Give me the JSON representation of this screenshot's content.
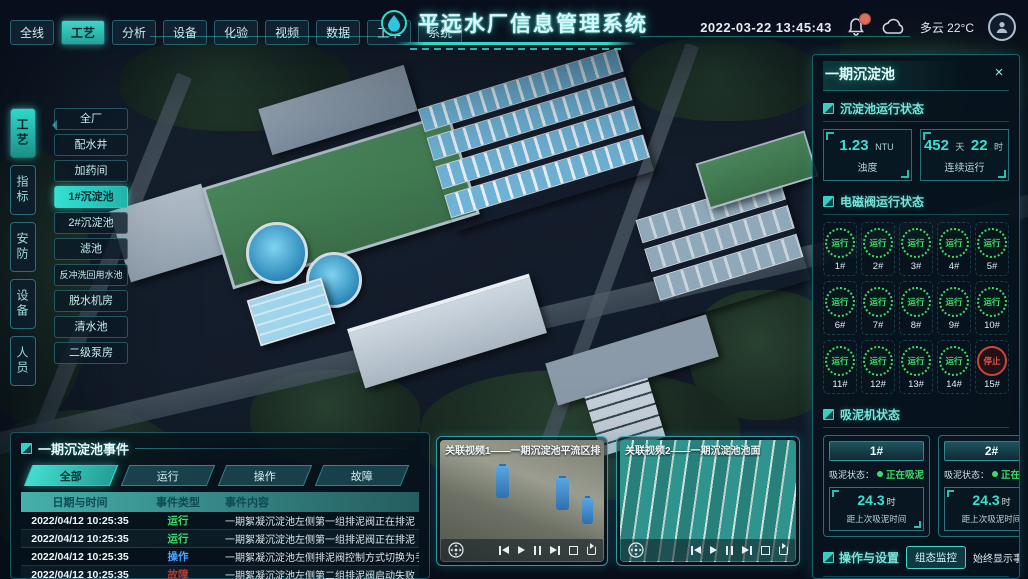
{
  "colors": {
    "accent": "#35d9c9",
    "run_green": "#3ddc68",
    "op_blue": "#4aa3ff",
    "fault_red": "#b03a2e",
    "stop_red": "#e05548"
  },
  "header": {
    "title": "平远水厂信息管理系统",
    "datetime": "2022-03-22 13:45:43",
    "weather": "多云 22°C",
    "nav_tabs": [
      {
        "label": "全线",
        "active": false
      },
      {
        "label": "工艺",
        "active": true
      },
      {
        "label": "分析",
        "active": false
      },
      {
        "label": "设备",
        "active": false
      },
      {
        "label": "化验",
        "active": false
      },
      {
        "label": "视频",
        "active": false
      },
      {
        "label": "数据",
        "active": false
      },
      {
        "label": "工单",
        "active": false
      },
      {
        "label": "系统",
        "active": false
      }
    ]
  },
  "left_nav": {
    "tabs": [
      {
        "label": "工艺",
        "active": true
      },
      {
        "label": "指标",
        "active": false
      },
      {
        "label": "安防",
        "active": false
      },
      {
        "label": "设备",
        "active": false
      },
      {
        "label": "人员",
        "active": false
      }
    ],
    "menu": [
      {
        "label": "全厂",
        "active": false
      },
      {
        "label": "配水井",
        "active": false
      },
      {
        "label": "加药间",
        "active": false
      },
      {
        "label": "1#沉淀池",
        "active": true
      },
      {
        "label": "2#沉淀池",
        "active": false
      },
      {
        "label": "滤池",
        "active": false
      },
      {
        "label": "反冲洗回用水池",
        "active": false
      },
      {
        "label": "脱水机房",
        "active": false
      },
      {
        "label": "清水池",
        "active": false
      },
      {
        "label": "二级泵房",
        "active": false
      }
    ]
  },
  "right_panel": {
    "title": "一期沉淀池",
    "run_status": {
      "title": "沉淀池运行状态",
      "stats": [
        {
          "value": "1.23",
          "unit": "NTU",
          "label": "浊度"
        },
        {
          "value": "452",
          "unit": "天",
          "value2": "22",
          "unit2": "时",
          "label": "连续运行"
        }
      ]
    },
    "valves": {
      "title": "电磁阀运行状态",
      "items": [
        {
          "id": "1#",
          "status": "运行",
          "state": "run"
        },
        {
          "id": "2#",
          "status": "运行",
          "state": "run"
        },
        {
          "id": "3#",
          "status": "运行",
          "state": "run"
        },
        {
          "id": "4#",
          "status": "运行",
          "state": "run"
        },
        {
          "id": "5#",
          "status": "运行",
          "state": "run"
        },
        {
          "id": "6#",
          "status": "运行",
          "state": "run"
        },
        {
          "id": "7#",
          "status": "运行",
          "state": "run"
        },
        {
          "id": "8#",
          "status": "运行",
          "state": "run"
        },
        {
          "id": "9#",
          "status": "运行",
          "state": "run"
        },
        {
          "id": "10#",
          "status": "运行",
          "state": "run"
        },
        {
          "id": "11#",
          "status": "运行",
          "state": "run"
        },
        {
          "id": "12#",
          "status": "运行",
          "state": "run"
        },
        {
          "id": "13#",
          "status": "运行",
          "state": "run"
        },
        {
          "id": "14#",
          "status": "运行",
          "state": "run"
        },
        {
          "id": "15#",
          "status": "停止",
          "state": "stop"
        }
      ]
    },
    "mud": {
      "title": "吸泥机状态",
      "status_label": "吸泥状态：",
      "machines": [
        {
          "id": "1#",
          "status": "正在吸泥",
          "value": "24.3",
          "unit": "时",
          "desc": "距上次吸泥时间"
        },
        {
          "id": "2#",
          "status": "正在吸泥",
          "value": "24.3",
          "unit": "时",
          "desc": "距上次吸泥时间"
        }
      ]
    },
    "ops": {
      "title": "操作与设置",
      "button": "组态监控",
      "toggle_label": "始终显示事件：",
      "toggle_on": true
    }
  },
  "events": {
    "title": "一期沉淀池事件",
    "tabs": [
      {
        "label": "全部",
        "active": true
      },
      {
        "label": "运行",
        "active": false
      },
      {
        "label": "操作",
        "active": false
      },
      {
        "label": "故障",
        "active": false
      }
    ],
    "columns": [
      "日期与时间",
      "事件类型",
      "事件内容"
    ],
    "rows": [
      {
        "datetime": "2022/04/12 10:25:35",
        "type": "运行",
        "type_class": "run",
        "content": "一期絮凝沉淀池左侧第一组排泥阀正在排泥"
      },
      {
        "datetime": "2022/04/12 10:25:35",
        "type": "运行",
        "type_class": "run",
        "content": "一期絮凝沉淀池左侧第一组排泥阀正在排泥"
      },
      {
        "datetime": "2022/04/12 10:25:35",
        "type": "操作",
        "type_class": "op",
        "content": "一期絮凝沉淀池左侧排泥阀控制方式切换为手动"
      },
      {
        "datetime": "2022/04/12 10:25:35",
        "type": "故障",
        "type_class": "fault",
        "content": "一期絮凝沉淀池左侧第二组排泥阀启动失败"
      }
    ]
  },
  "videos": [
    {
      "title": "关联视频1——一期沉淀池平流区排泥管廊"
    },
    {
      "title": "关联视频2——一期沉淀池池面"
    }
  ]
}
